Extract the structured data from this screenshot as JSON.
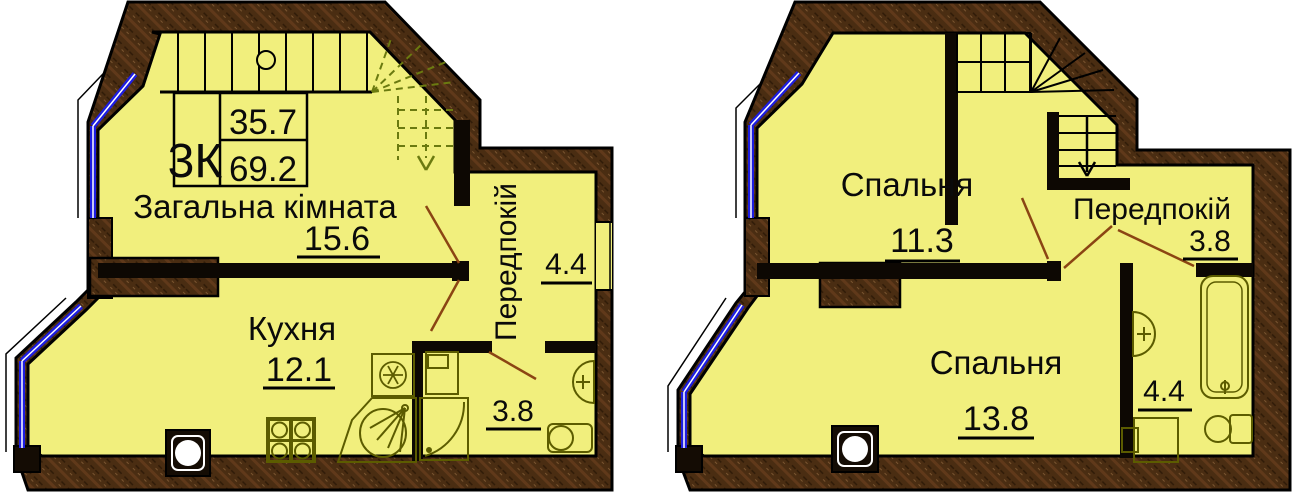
{
  "level1": {
    "info_box": {
      "type": "3К",
      "upper_value": "35.7",
      "lower_value": "69.2"
    },
    "living_room": {
      "label": "Загальна кімната",
      "area": "15.6"
    },
    "kitchen": {
      "label": "Кухня",
      "area": "12.1"
    },
    "hallway": {
      "label": "Передпокій",
      "area": "4.4"
    },
    "bathroom": {
      "area": "3.8"
    }
  },
  "level2": {
    "bedroom1": {
      "label": "Спальня",
      "area": "11.3"
    },
    "bedroom2": {
      "label": "Спальня",
      "area": "13.8"
    },
    "hallway": {
      "label": "Передпокій",
      "area": "3.8"
    },
    "bathroom": {
      "area": "4.4"
    }
  },
  "colors": {
    "floor": "#f1ef7d",
    "wall": "#4a2d12",
    "outline": "#000000",
    "window_blue": "#1d1de0",
    "door_brown": "#8b4513",
    "fixture_olive": "#5c5c00",
    "stair_dash_green": "#6b7a10"
  }
}
